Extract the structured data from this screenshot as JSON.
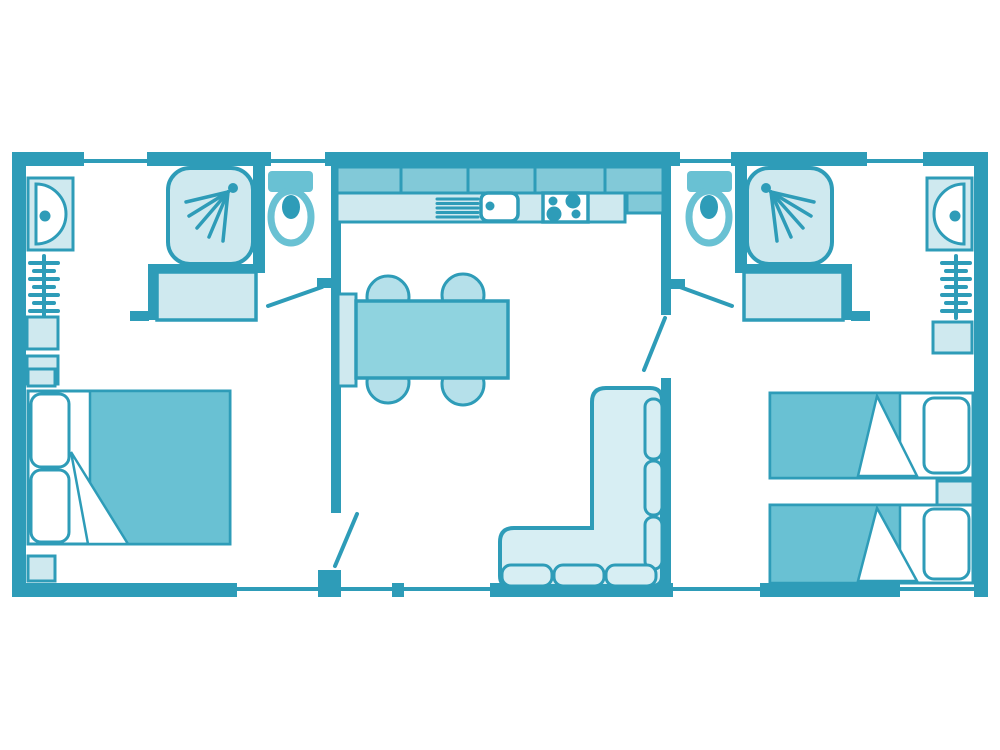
{
  "image_type": "floor-plan-diagram",
  "colors": {
    "background": "#ffffff",
    "wall": "#2e9cb8",
    "accent_medium": "#69c1d3",
    "cabinet_medium": "#82c9d8",
    "table_medium": "#8fd3df",
    "chair_light": "#b5e0ea",
    "furniture_light": "#cfe9ef",
    "sofa_light": "#d7eef3"
  },
  "floorplan": {
    "rooms": [
      {
        "id": "bedroom-left",
        "furniture": [
          "double-bed",
          "pillows",
          "duvet",
          "nightstand-top",
          "nightstand-bottom",
          "wash-basin",
          "towel-radiator",
          "storage-shelves"
        ]
      },
      {
        "id": "shower-room-left",
        "furniture": [
          "shower-cabin",
          "vanity-unit"
        ]
      },
      {
        "id": "wc-left",
        "furniture": [
          "toilet"
        ]
      },
      {
        "id": "kitchen",
        "furniture": [
          "wall-cabinets",
          "worktop",
          "draining-board",
          "kitchen-sink",
          "hob",
          "tall-unit"
        ]
      },
      {
        "id": "dining-area",
        "furniture": [
          "dining-table",
          "wall-bench",
          "chair",
          "chair",
          "chair",
          "chair"
        ]
      },
      {
        "id": "living-area",
        "furniture": [
          "corner-sofa",
          "back-cushions",
          "seat-cushions"
        ]
      },
      {
        "id": "wc-right",
        "furniture": [
          "toilet"
        ]
      },
      {
        "id": "shower-room-right",
        "furniture": [
          "shower-cabin",
          "vanity-unit"
        ]
      },
      {
        "id": "bedroom-right",
        "furniture": [
          "single-bed",
          "single-bed",
          "pillows",
          "nightstand",
          "wash-basin",
          "towel-radiator",
          "storage-shelf"
        ]
      }
    ],
    "doors": [
      "bedroom-left-door",
      "wc-left-door",
      "bedroom-right-door",
      "wc-right-door"
    ],
    "window_count_top": 4,
    "window_count_bottom": 5
  }
}
